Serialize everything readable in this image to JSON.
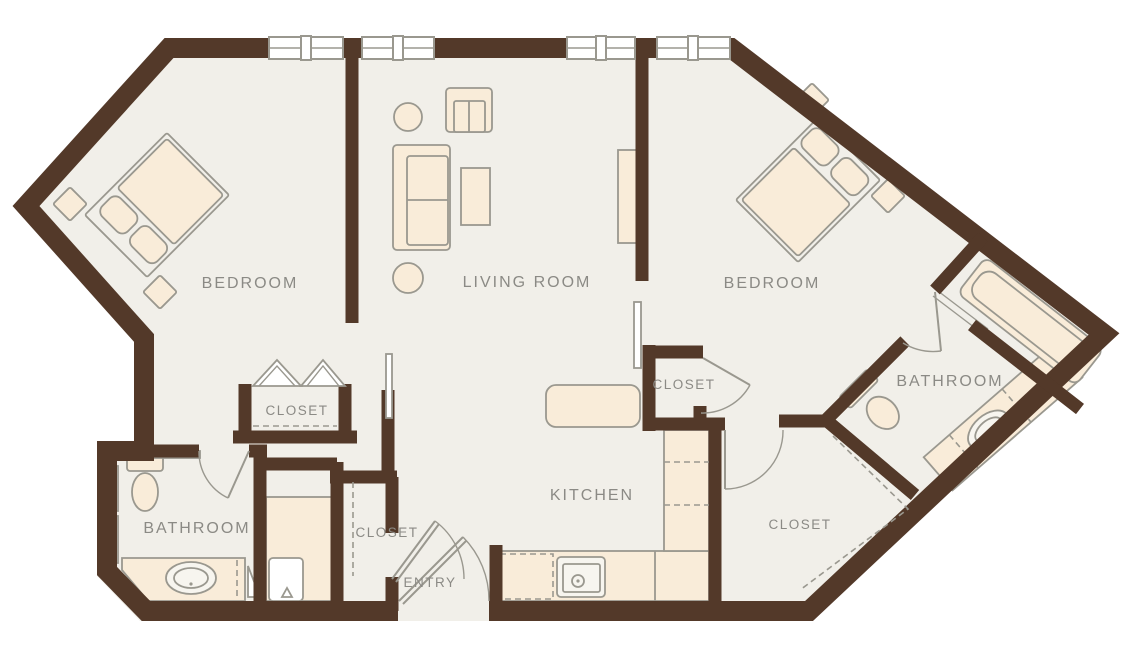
{
  "plan": {
    "type": "apartment-floor-plan",
    "rooms": {
      "bedroom_left": "BEDROOM",
      "living_room": "LIVING ROOM",
      "bedroom_right": "BEDROOM",
      "closet_bedroom_left": "CLOSET",
      "closet_middle": "CLOSET",
      "bathroom_left": "BATHROOM",
      "closet_entry": "CLOSET",
      "entry": "ENTRY",
      "kitchen": "KITCHEN",
      "bathroom_right": "BATHROOM",
      "closet_walk_in": "CLOSET"
    },
    "colors": {
      "wall": "#533929",
      "floor": "#f1efe9",
      "furn": "#f9ecd9",
      "line": "#9a988f",
      "label": "#8b8a85",
      "bg": "#ffffff"
    }
  }
}
